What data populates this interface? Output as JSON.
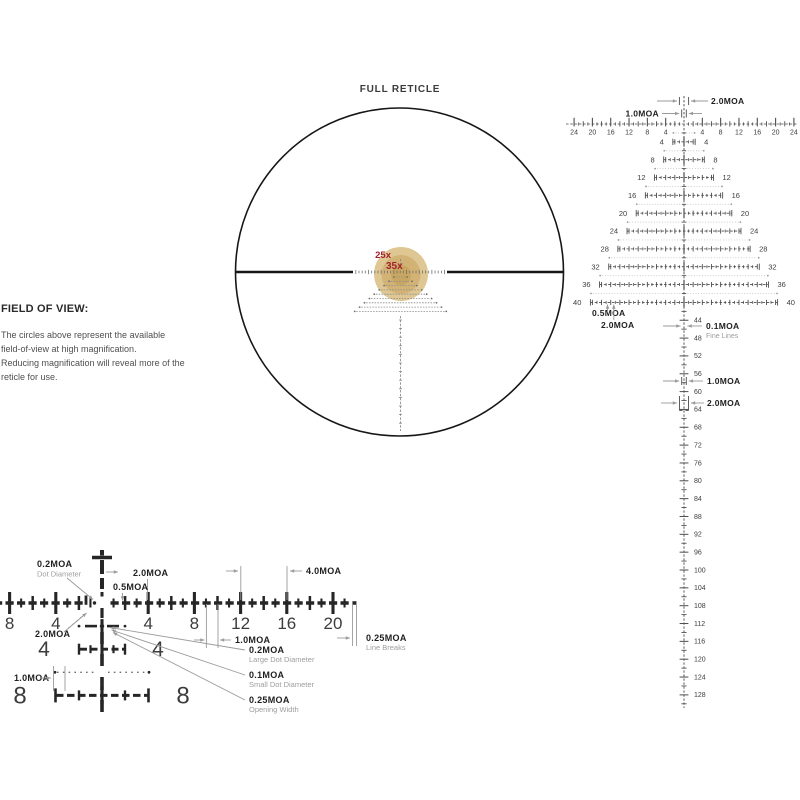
{
  "full_reticle": {
    "title": "FULL RETICLE",
    "mag_outer": "25x",
    "mag_inner": "35x"
  },
  "field_of_view": {
    "heading": "FIELD OF VIEW:",
    "body_lines": [
      "The circles above represent the available",
      "field-of-view at high magnification.",
      "Reducing magnification will reveal more of the",
      "reticle for use."
    ]
  },
  "right_diagram": {
    "h_scale_labels_left": [
      "24",
      "20",
      "16",
      "12",
      "8",
      "4"
    ],
    "h_scale_labels_right": [
      "4",
      "8",
      "12",
      "16",
      "20",
      "24"
    ],
    "tree_row_labels": [
      "4",
      "8",
      "12",
      "16",
      "20",
      "24",
      "28",
      "32",
      "36",
      "40"
    ],
    "v_scale_labels": [
      "44",
      "48",
      "52",
      "56",
      "60",
      "64",
      "68",
      "72",
      "76",
      "80",
      "84",
      "88",
      "92",
      "96",
      "100",
      "104",
      "108",
      "112",
      "116",
      "120",
      "124",
      "128"
    ],
    "ann_top_2moa": "2.0MOA",
    "ann_top_1moa": "1.0MOA",
    "ann_bottom_05moa": "0.5MOA",
    "ann_bottom_2moa": "2.0MOA",
    "ann_fine_lines": "0.1MOA",
    "ann_fine_lines_sub": "Fine Lines",
    "ann_v_1moa": "1.0MOA",
    "ann_v_2moa": "2.0MOA"
  },
  "detail_diagram": {
    "h_scale_labels": [
      "8",
      "4",
      "4",
      "8",
      "12",
      "16",
      "20"
    ],
    "row4_labels": [
      "4",
      "4"
    ],
    "row8_labels": [
      "8",
      "8"
    ],
    "ann_dot_diameter": "0.2MOA",
    "ann_dot_diameter_sub": "Dot Diameter",
    "ann_top_2moa": "2.0MOA",
    "ann_05moa": "0.5MOA",
    "ann_4moa": "4.0MOA",
    "ann_left_2moa": "2.0MOA",
    "ann_left_1moa": "1.0MOA",
    "ann_mid_1moa": "1.0MOA",
    "ann_line_breaks": "0.25MOA",
    "ann_line_breaks_sub": "Line Breaks",
    "ann_large_dot": "0.2MOA",
    "ann_large_dot_sub": "Large Dot Diameter",
    "ann_small_dot": "0.1MOA",
    "ann_small_dot_sub": "Small Dot Diameter",
    "ann_opening": "0.25MOA",
    "ann_opening_sub": "Opening Width"
  },
  "colors": {
    "outline": "#161616",
    "dark": "#262626",
    "num_dark": "#3c3c3c",
    "diagram_gray": "#4d4d4d",
    "dotted_gray": "#bdbdbd",
    "dot_end": "#9a9a9a",
    "ann_line": "#9a9a9a",
    "ann_text": "#1f1f1f",
    "ann_sub": "#9d9d9d",
    "mini_gray": "#8e8e8e",
    "red": "#a5202f",
    "gold_outer": "#dec792",
    "gold_mid": "#d2b375",
    "gold_core": "#c9a761"
  }
}
